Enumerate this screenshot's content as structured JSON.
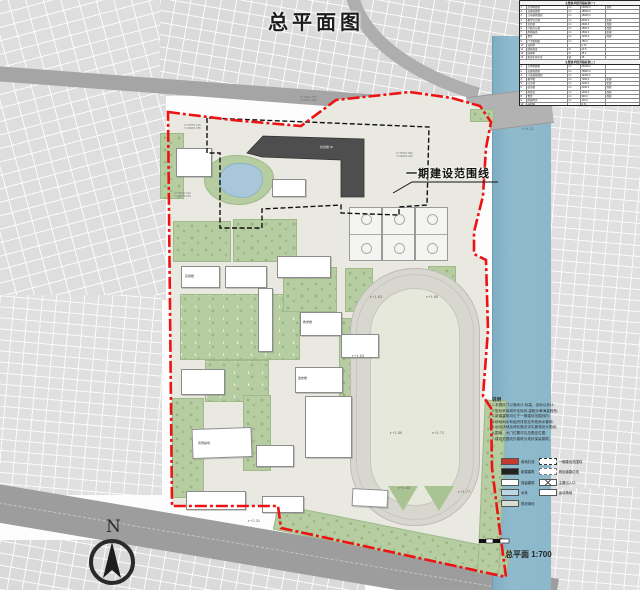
{
  "title": "总平面图",
  "north_label": "N",
  "phase1_label": "一期建设范围线",
  "scale_label": "总平面 1:700",
  "colors": {
    "boundary_red": "#ee1313",
    "river_blue": "#8cb8cc",
    "green": "#b6cda2",
    "dark_building": "#4e4e4e",
    "road_gray": "#a5a5a5"
  },
  "dark_building_label": "综合楼 4F",
  "notes": {
    "title": "说明",
    "lines": [
      "1.本图尺寸以毫米计,标高、坐标以米计;",
      "2.坐标采用城市坐标系,高程为黄海高程系;",
      "3.新建建筑均位于一期建设范围线内;",
      "4.场地雨水有组织排放至市政雨水管网;",
      "5.运动场地及绿化做法详见景观设计图纸;",
      "6.围墙、大门位置详见总图定位图;",
      "7.建设范围线外建筑为现状保留建筑。"
    ]
  },
  "legend": {
    "left": [
      {
        "swatch": "#c43b2e",
        "label": "用地红线"
      },
      {
        "swatch": "#222222",
        "label": "新建建筑"
      },
      {
        "swatch": "#ffffff",
        "label": "保留建筑"
      },
      {
        "swatch": "#bdd7e4",
        "label": "水系"
      },
      {
        "swatch": "#d8ddd2",
        "label": "现状绿化"
      }
    ],
    "right": [
      {
        "style": "dash",
        "label": "一期建设范围线"
      },
      {
        "style": "dash2",
        "label": "规划道路红线"
      },
      {
        "style": "cross",
        "label": "主要出入口"
      },
      {
        "style": "box",
        "label": "运动场地"
      }
    ]
  },
  "table": {
    "sections": [
      {
        "header": "主要技术经济指标表(一)",
        "rows": [
          [
            "1",
            "总用地面积",
            "m²",
            "23250.0",
            "现状"
          ],
          [
            "2",
            "总建筑面积",
            "m²",
            "18600.0",
            ""
          ],
          [
            "3",
            "计容建筑面积",
            "m²",
            "16200.0",
            ""
          ],
          [
            "4",
            "教学综合楼",
            "m²",
            "8400.0",
            "新建"
          ],
          [
            "5",
            "实验楼",
            "m²",
            "2600.0",
            "保留"
          ],
          [
            "6",
            "行政办公楼",
            "m²",
            "1800.0",
            "保留"
          ],
          [
            "7",
            "风雨操场",
            "m²",
            "1500.0",
            "新建"
          ],
          [
            "8",
            "食堂",
            "m²",
            "1200.0",
            "保留"
          ],
          [
            "9",
            "门卫及附属",
            "m²",
            "150.0",
            ""
          ],
          [
            "10",
            "容积率",
            "",
            "0.70",
            ""
          ],
          [
            "11",
            "建筑密度",
            "%",
            "22.5",
            ""
          ],
          [
            "12",
            "绿地率",
            "%",
            "35.2",
            ""
          ],
          [
            "13",
            "机动车停车位",
            "辆",
            "45",
            ""
          ]
        ]
      },
      {
        "header": "主要技术经济指标表(二)",
        "rows": [
          [
            "1",
            "总用地面积",
            "m²",
            "20130.0",
            ""
          ],
          [
            "2",
            "总建筑面积",
            "m²",
            "15800.0",
            ""
          ],
          [
            "3",
            "计容建筑面积",
            "m²",
            "14300.0",
            ""
          ],
          [
            "4",
            "教学楼",
            "m²",
            "7200.0",
            "新建"
          ],
          [
            "5",
            "综合楼",
            "m²",
            "3100.0",
            "新建"
          ],
          [
            "6",
            "宿舍楼",
            "m²",
            "2200.0",
            "保留"
          ],
          [
            "7",
            "体育馆",
            "m²",
            "1400.0",
            "保留"
          ],
          [
            "8",
            "食堂",
            "m²",
            "900.0",
            "保留"
          ],
          [
            "9",
            "附属用房",
            "m²",
            "120.0",
            ""
          ],
          [
            "10",
            "容积率",
            "",
            "0.71",
            ""
          ],
          [
            "11",
            "建筑密度",
            "%",
            "23.0",
            ""
          ],
          [
            "12",
            "绿地率",
            "%",
            "34.8",
            ""
          ],
          [
            "13",
            "非机动车停车位",
            "辆",
            "320",
            ""
          ]
        ]
      }
    ],
    "footer": "注:以上指标以规划主管部门核定为准"
  },
  "spot_elevations": [
    {
      "x": 370,
      "y": 294,
      "t": "+1.63"
    },
    {
      "x": 426,
      "y": 294,
      "t": "+1.65"
    },
    {
      "x": 352,
      "y": 353,
      "t": "+1.63"
    },
    {
      "x": 390,
      "y": 430,
      "t": "+1.59"
    },
    {
      "x": 432,
      "y": 430,
      "t": "+1.71"
    },
    {
      "x": 398,
      "y": 485,
      "t": "+1.60"
    },
    {
      "x": 458,
      "y": 489,
      "t": "+1.77"
    },
    {
      "x": 522,
      "y": 126,
      "t": "+4.21"
    },
    {
      "x": 248,
      "y": 518,
      "t": "+2.31"
    }
  ],
  "coord_labels": [
    {
      "x": 184,
      "y": 124,
      "line1": "X=78787.125",
      "line2": "Y=28083.785"
    },
    {
      "x": 174,
      "y": 192,
      "line1": "X=78741.312",
      "line2": "Y=28079.158"
    },
    {
      "x": 396,
      "y": 152,
      "line1": "X=78767.081",
      "line2": "Y=28166.420"
    },
    {
      "x": 300,
      "y": 96,
      "line1": "X=78801.554",
      "line2": "Y=28131.906"
    }
  ],
  "building_labels": [
    {
      "x": 303,
      "y": 320,
      "t": "教学楼"
    },
    {
      "x": 185,
      "y": 274,
      "t": "实验楼"
    },
    {
      "x": 298,
      "y": 376,
      "t": "宿舍楼"
    },
    {
      "x": 198,
      "y": 441,
      "t": "风雨操场"
    }
  ]
}
